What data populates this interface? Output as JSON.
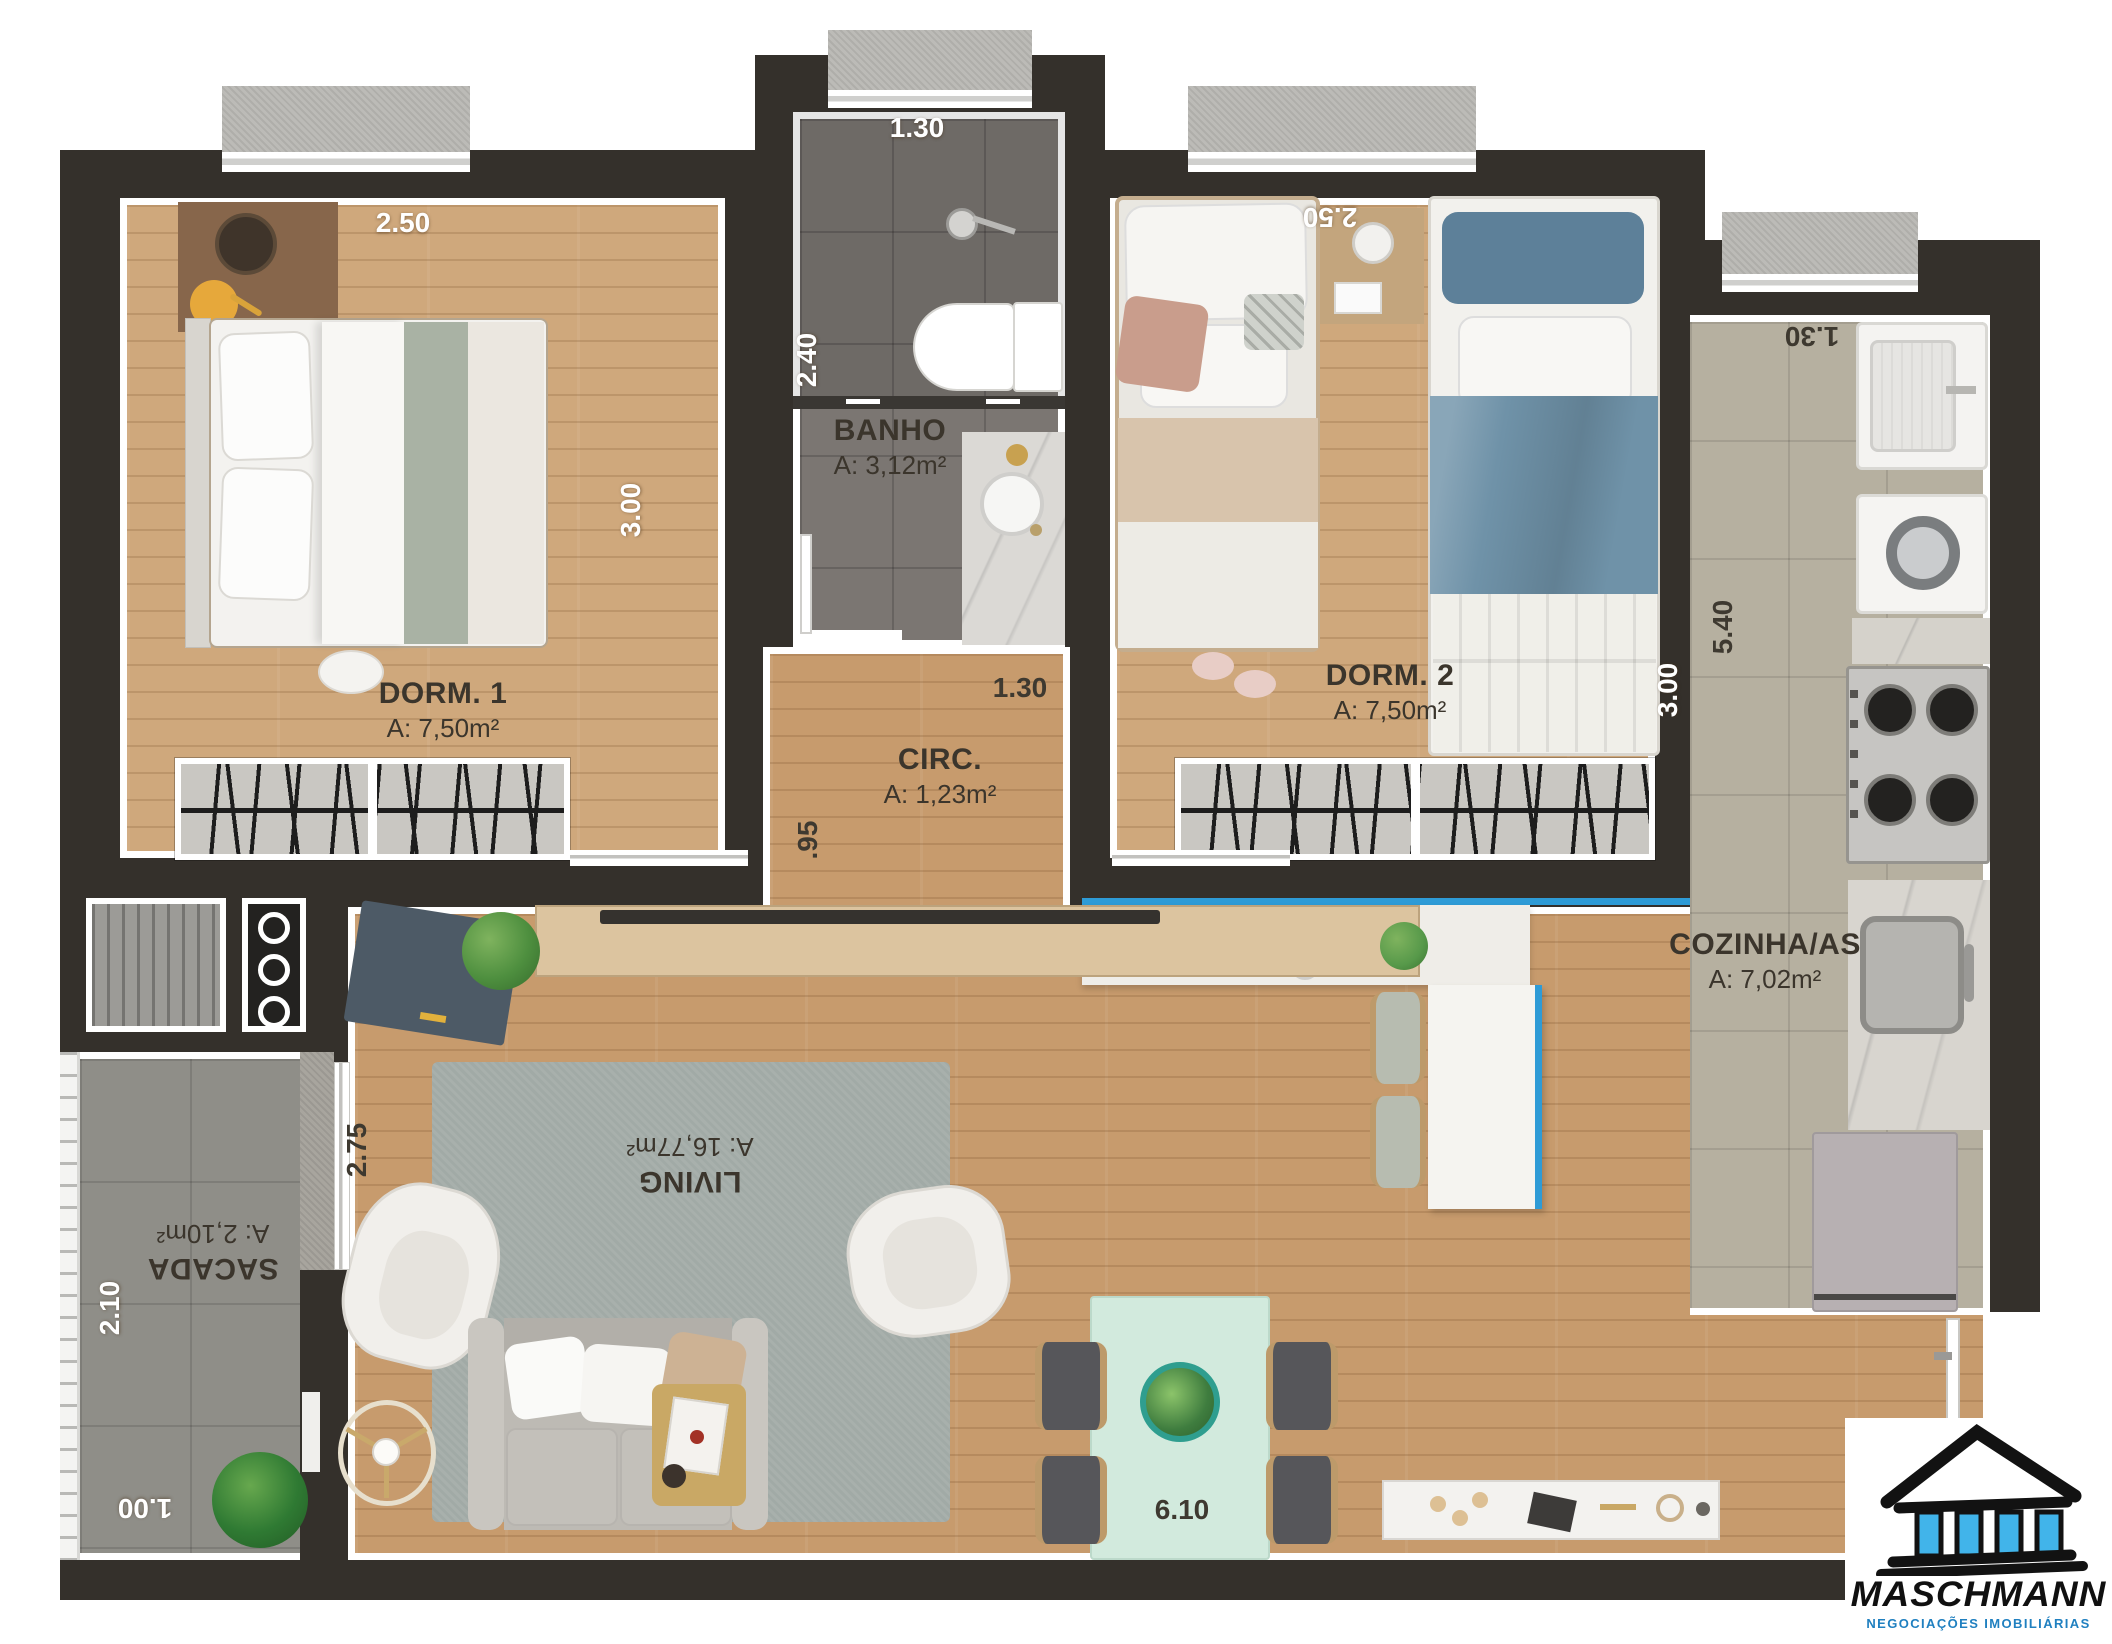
{
  "title": "Apartment floor plan",
  "rooms": {
    "dorm1": {
      "name": "DORM. 1",
      "area": "A: 7,50m²"
    },
    "banho": {
      "name": "BANHO",
      "area": "A: 3,12m²"
    },
    "dorm2": {
      "name": "DORM. 2",
      "area": "A: 7,50m²"
    },
    "circ": {
      "name": "CIRC.",
      "area": "A: 1,23m²"
    },
    "cozinha": {
      "name": "COZINHA/AS",
      "area": "A: 7,02m²"
    },
    "living": {
      "name": "LIVING",
      "area": "A: 16,77m²"
    },
    "sacada": {
      "name": "SACADA",
      "area": "A: 2,10m²"
    }
  },
  "dims": {
    "dorm1_w": "2.50",
    "dorm1_d": "3.00",
    "banho_w": "1.30",
    "banho_d": "2.40",
    "dorm2_w": "2.50",
    "dorm2_d": "3.00",
    "kitchen_w": "1.30",
    "kitchen_d": "5.40",
    "circ_pass": "1.30",
    "circ_w": ".95",
    "living_w": "2.75",
    "sacada_d": "2.10",
    "sacada_w": "1.00",
    "dining_w": "6.10"
  },
  "logo": {
    "brand": "MASCHMANN",
    "tagline": "NEGOCIAÇÕES IMOBILIÁRIAS"
  },
  "icons": {
    "logo_mark": "greek-temple-icon"
  },
  "colors": {
    "wall": "#34302b",
    "wood_floor": "#c79b6d",
    "bath_tile": "#7b7672",
    "kitchen_tile": "#b6b0a0",
    "balcony_tile": "#8f8e88",
    "rug": "#a1aaa6",
    "counter_edge_blue": "#2e9bd6",
    "dining_table_mint": "#d2eadd",
    "bed2_blue": "#6f92a8",
    "logo_column_blue": "#41b4ea",
    "logo_text_blue": "#2080c0"
  }
}
